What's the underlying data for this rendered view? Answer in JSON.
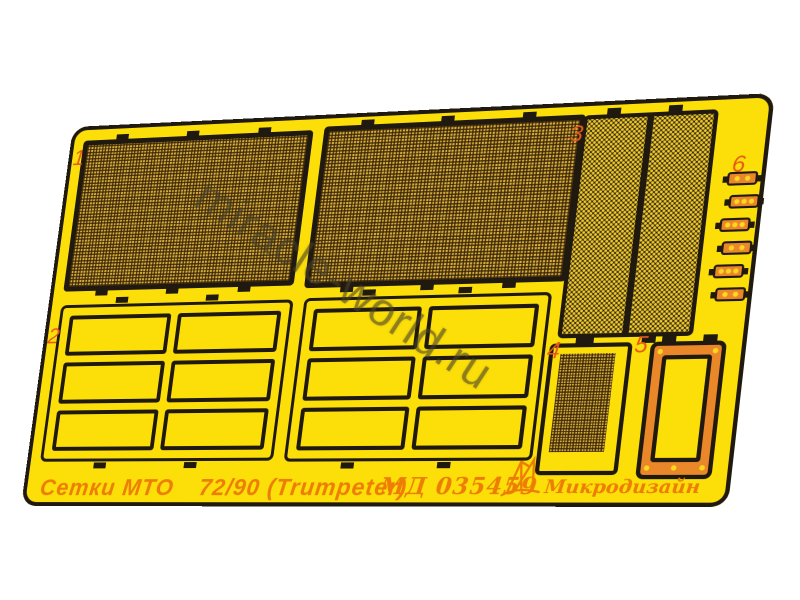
{
  "colors": {
    "plate": "#fcdf08",
    "outline": "#201910",
    "orange": "#ea8728",
    "labels": "#e8591a",
    "footer_text": "#ed7d05",
    "dot": "#ffd81e",
    "mesh_base": "#d7ae3a",
    "mesh_line": "rgba(52,32,6,0.8)",
    "diag_base": "#362a0c",
    "diag_dot": "#f0ca30",
    "watermark": "rgba(72,64,40,0.5)"
  },
  "watermark": {
    "text": "miracle-world.ru"
  },
  "footer": {
    "product_name": "Сетки МТО",
    "scale_info": "72/90 (Trumpeter)",
    "product_code": "МД 035459",
    "brand_name": "Микродизайн"
  },
  "parts": {
    "items": [
      {
        "number": "1"
      },
      {
        "number": "2"
      },
      {
        "number": "3"
      },
      {
        "number": "4"
      },
      {
        "number": "5"
      },
      {
        "number": "6"
      }
    ]
  }
}
